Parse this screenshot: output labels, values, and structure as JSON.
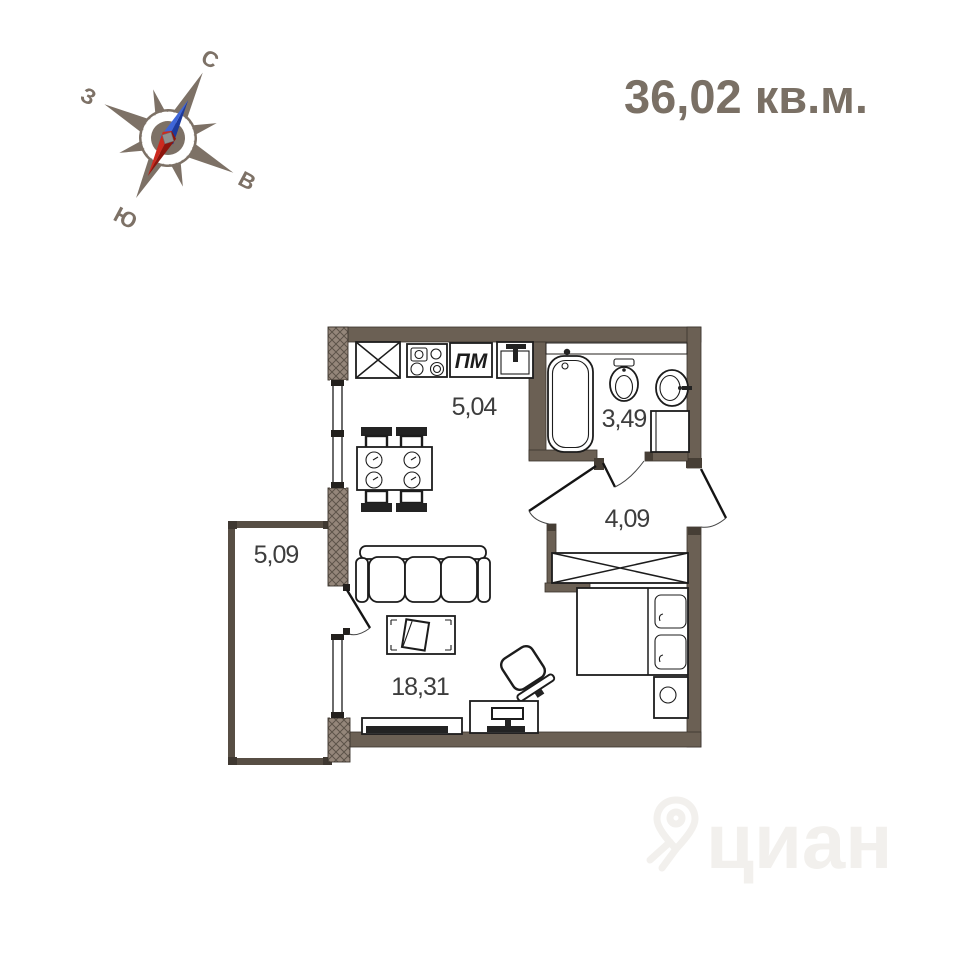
{
  "title": {
    "area_label": "36,02 кв.м."
  },
  "compass": {
    "north_label": "С",
    "west_label": "З",
    "east_label": "В",
    "south_label": "Ю"
  },
  "rooms": {
    "kitchen": {
      "area": "5,04"
    },
    "bathroom": {
      "area": "3,49"
    },
    "hallway": {
      "area": "4,09"
    },
    "living_room": {
      "area": "18,31"
    },
    "balcony": {
      "area": "5,09"
    }
  },
  "labels": {
    "dishwasher": "ПМ"
  },
  "watermark": {
    "brand": "циан"
  },
  "colors": {
    "wall": "#6b6054",
    "wall_dark": "#463e35",
    "balcony_wall": "#574e44",
    "hatch_bg": "#94867a",
    "hatch_line": "#5c5349",
    "accent_title": "#7a7065",
    "compass": "#7d7166",
    "needle_north_light": "#3f66d9",
    "needle_north_dark": "#1d3a9c",
    "needle_south_light": "#cc2a1f",
    "needle_south_dark": "#8e150d",
    "label_text": "#3d3d3d",
    "watermark": "#f2f0ed"
  }
}
